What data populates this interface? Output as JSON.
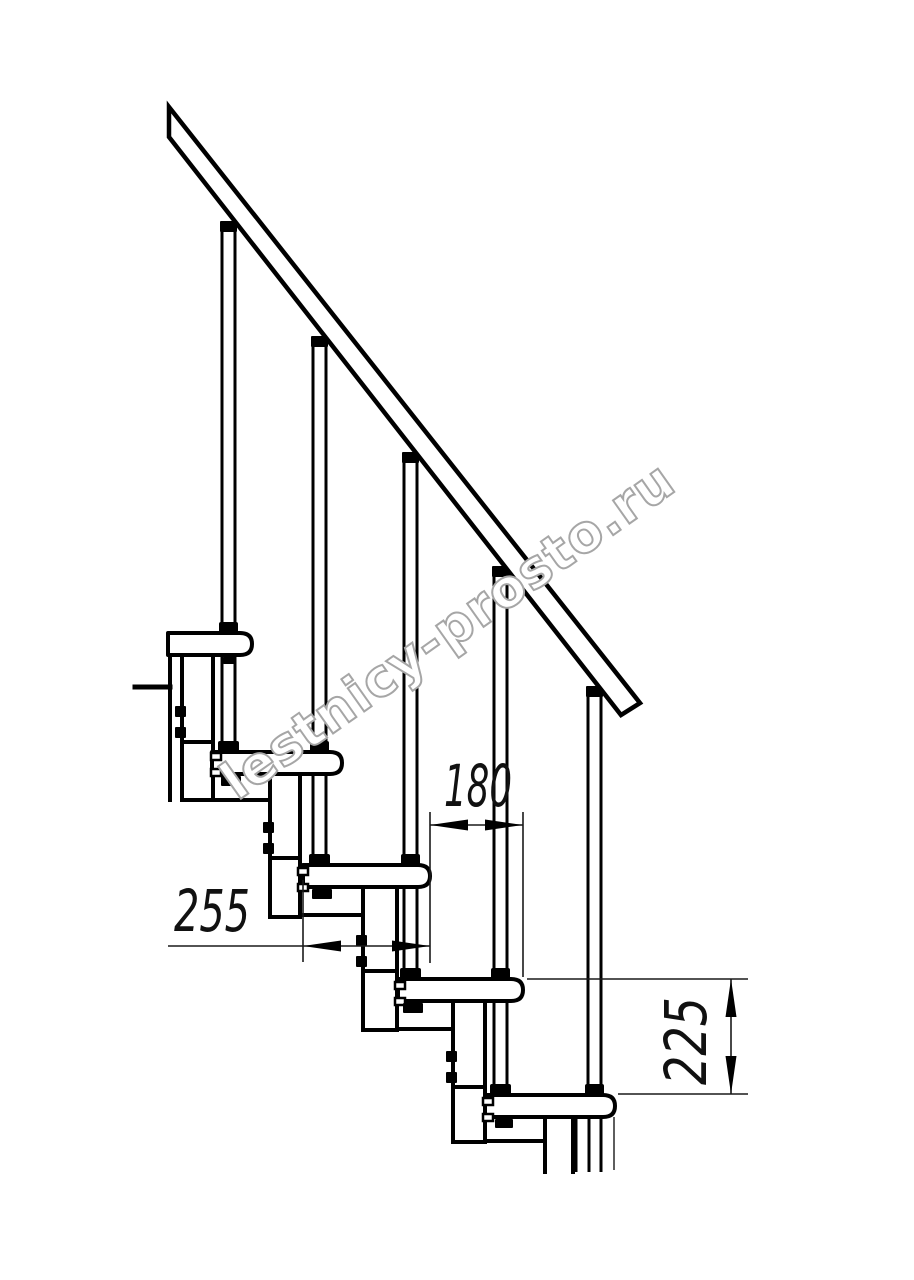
{
  "drawing": {
    "kind": "staircase-side-view-technical-drawing",
    "steps_visible": 5,
    "balusters_visible": 5
  },
  "dimensions": {
    "run": {
      "label": "180",
      "value": 180
    },
    "depth": {
      "label": "255",
      "value": 255
    },
    "rise": {
      "label": "225",
      "value": 225
    }
  },
  "watermark": {
    "text": "lestnicy-prosto.ru",
    "stroke_color": "#a6a6a6",
    "fill_color": "#ffffff"
  },
  "colors": {
    "ink": "#000000",
    "thin_line": "#1a1a1a",
    "background": "#ffffff"
  }
}
